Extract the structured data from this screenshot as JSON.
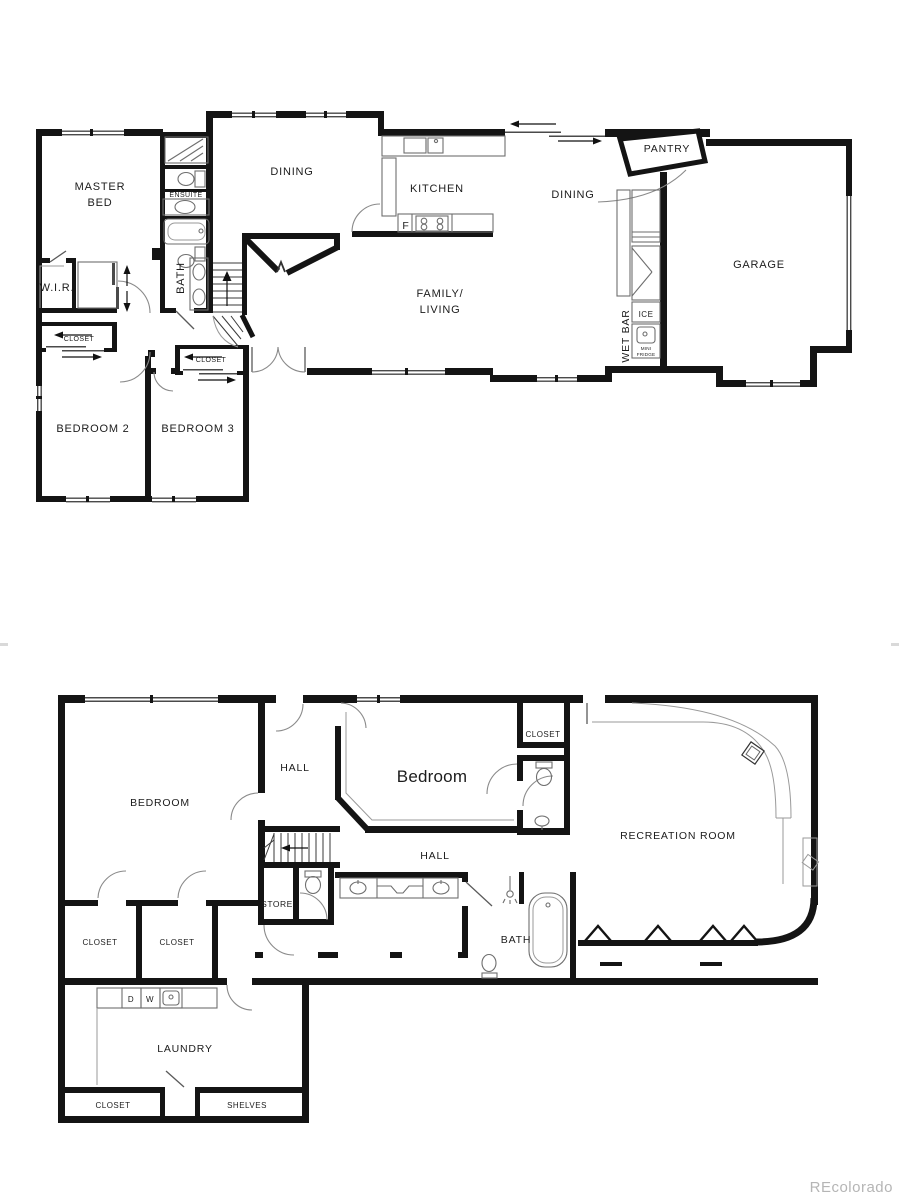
{
  "title": "Two-level residential floor plan",
  "colors": {
    "wall": "#141414",
    "background": "#ffffff",
    "fixture_outline": "#6e6e6e",
    "door_arc": "#8a8a8a",
    "watermark": "#b5b5b5"
  },
  "upper_floor": {
    "rooms": {
      "master_line1": "MASTER",
      "master_line2": "BED",
      "ensuite": "ENSUITE",
      "bath": "BATH",
      "wir": "W.I.R.",
      "closet_master": "CLOSET",
      "closet_hall": "CLOSET",
      "bedroom2": "BEDROOM 2",
      "bedroom3": "BEDROOM 3",
      "dining_left": "DINING",
      "kitchen": "KITCHEN",
      "fridge_f": "F",
      "dining_right": "DINING",
      "family_line1": "FAMILY/",
      "family_line2": "LIVING",
      "pantry": "PANTRY",
      "wet_bar": "WET BAR",
      "ice": "ICE",
      "mini_fridge_line1": "MINI",
      "mini_fridge_line2": "FRIDGE",
      "garage": "GARAGE"
    }
  },
  "lower_floor": {
    "rooms": {
      "bedroom_left": "BEDROOM",
      "hall_upper": "HALL",
      "bedroom_middle": "Bedroom",
      "closet_bedroom": "CLOSET",
      "recreation": "RECREATION ROOM",
      "store": "STORE",
      "closet1": "CLOSET",
      "closet2": "CLOSET",
      "hall_lower": "HALL",
      "bath": "BATH",
      "dryer": "D",
      "washer": "W",
      "laundry": "LAUNDRY",
      "closet_laundry": "CLOSET",
      "shelves": "SHELVES"
    }
  },
  "watermark": "REcolorado"
}
